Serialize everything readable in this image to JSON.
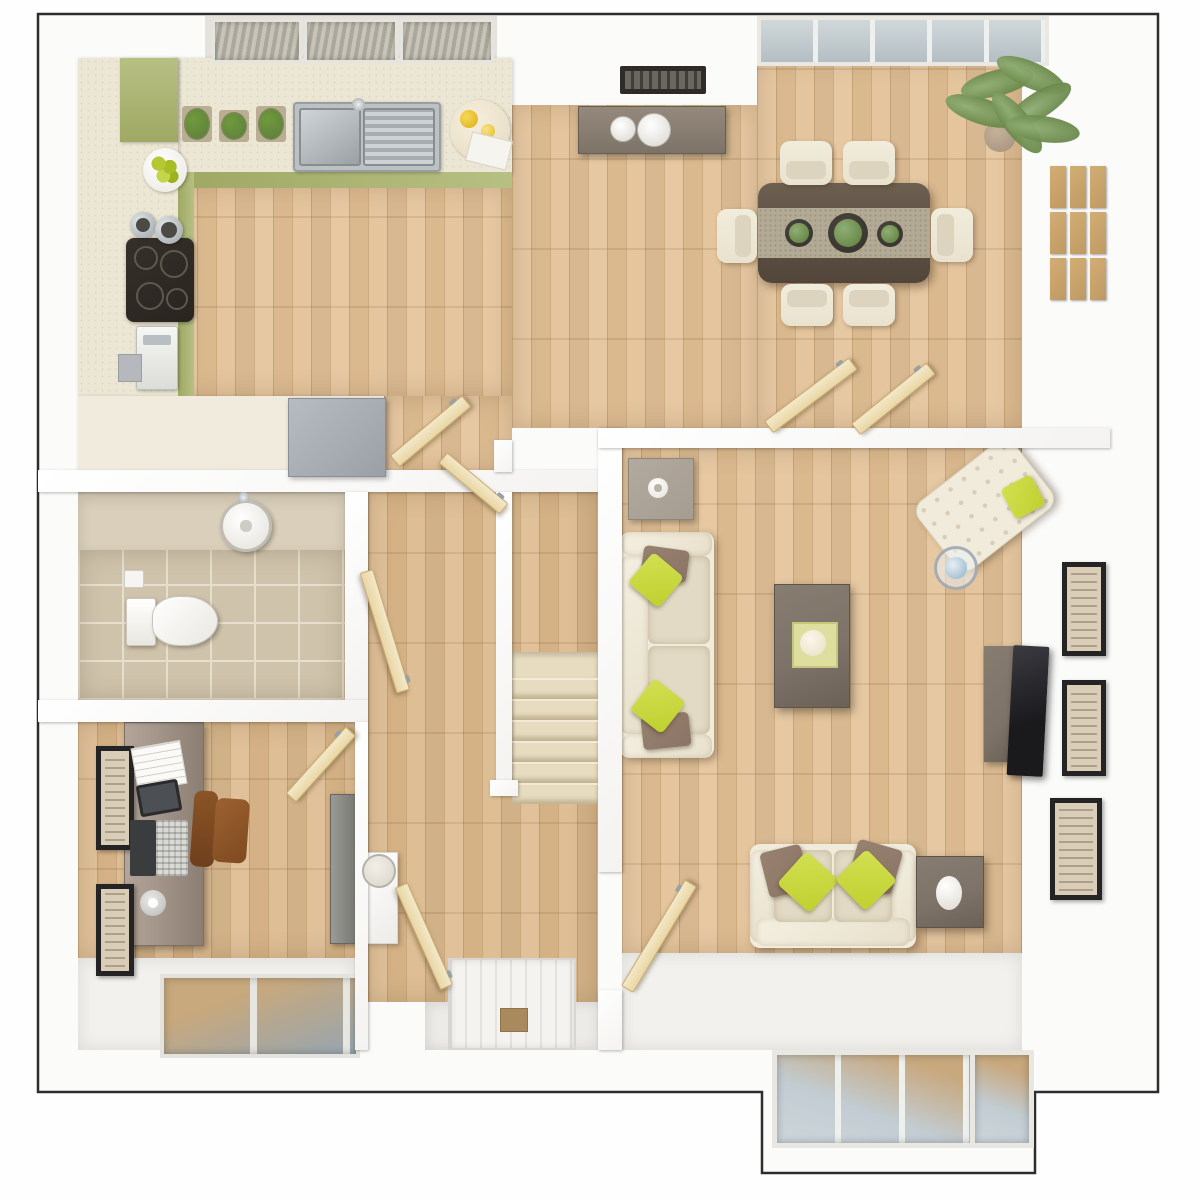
{
  "scene": {
    "kind": "architectural-floor-plan",
    "style": "3d-top-down-render",
    "visible_text": "none"
  },
  "palette": {
    "outline": "#2d2d2d",
    "wall": "#fbfbfa",
    "wood": "#e3c298",
    "wood_dark": "#dcba8e",
    "counter": "#ece6d4",
    "green": "#9fa964",
    "green_light": "#b7c083",
    "steel": "#bcc1c4",
    "hob": "#29241f",
    "tile": "#cfc3ab",
    "grout": "#e7dfcd",
    "tile_top": "#d9cfba",
    "door": "#e9d6a4",
    "door_edge": "#c8ab72",
    "stair": "#e7dcc0",
    "stair_edge": "#f2ead4",
    "cream": "#e9e2cf",
    "cream_light": "#f1ebdc",
    "cushion": "#e2dac4",
    "pillow_green": "#c0d02f",
    "pillow_brown": "#8b7466",
    "walnut": "#63564a",
    "runner": "#b2aa95",
    "gray_furn": "#7d7368",
    "gray_table": "#a59c92",
    "tv": "#1a191c",
    "frame": "#242424",
    "frame_wood": "#bf9a63",
    "photo": "#d9cdb7",
    "glass_wood": "#c8a87d",
    "leather": "#6f3f1d",
    "plant": "#5d7c3c",
    "plant_light": "#8fae74",
    "lime": "#b5c832",
    "mat": "#a88a5c",
    "fridge": "#9aa0a6"
  },
  "counts": {
    "stair_steps": 6,
    "dining_chairs": 6,
    "wall_frame_grid_rows": 3,
    "wall_frame_grid_cols": 3,
    "right_wall_frames": 3,
    "study_frames": 2,
    "herb_pots": 3,
    "hob_burners": 4,
    "table_centerpieces": 3,
    "kitchen_roof_windows": 3,
    "interior_doors": 7,
    "dining_double_doors": 2
  },
  "rooms": [
    {
      "id": "kitchen",
      "furniture": [
        "l-shaped-worktop",
        "tall-green-cabinet",
        "green-base-units",
        "herb-pots",
        "double-sink-with-drainer",
        "round-chopping-board-lemons",
        "fruit-bowl",
        "saucepans",
        "induction-hob",
        "coffee-machine",
        "peninsula-unit",
        "gray-appliance",
        "roof-windows"
      ]
    },
    {
      "id": "dining-room",
      "furniture": [
        "sideboard",
        "serving-bowls",
        "wall-vent",
        "dining-table",
        "table-runner",
        "centerpiece-plants",
        "six-chairs",
        "palm-plant",
        "wooden-frame-grid",
        "glazed-doors"
      ]
    },
    {
      "id": "living-room",
      "furniture": [
        "side-table-with-candle",
        "three-seat-sofa",
        "coffee-table-with-tray",
        "chaise-armchair",
        "round-glass-table",
        "tv-unit",
        "television",
        "two-seat-sofa",
        "side-table-with-vase",
        "wall-frames",
        "bay-window",
        "double-doors-to-dining"
      ]
    },
    {
      "id": "hallway",
      "furniture": [
        "staircase",
        "half-wall",
        "front-door",
        "door-mat",
        "console-with-mirror",
        "internal-doors"
      ]
    },
    {
      "id": "bathroom",
      "furniture": [
        "pedestal-basin",
        "toilet",
        "toilet-roll-holder",
        "tiled-floor"
      ]
    },
    {
      "id": "study",
      "furniture": [
        "desk",
        "documents",
        "tablet",
        "laptop",
        "desk-lamp",
        "leather-office-chair",
        "wall-frames",
        "tall-cabinet",
        "window"
      ]
    }
  ]
}
